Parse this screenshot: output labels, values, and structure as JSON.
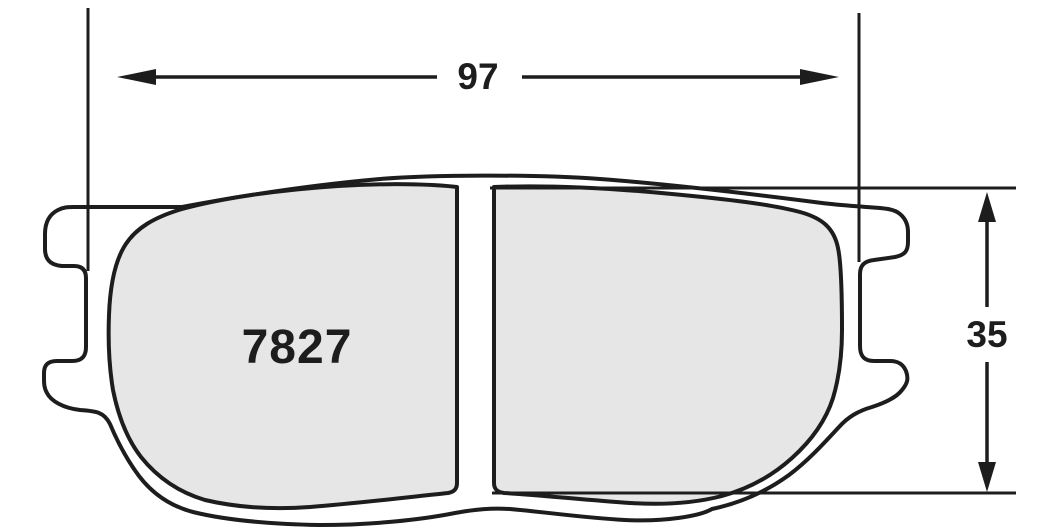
{
  "part": {
    "number_label": "7827"
  },
  "dimensions": {
    "width_label": "97",
    "height_label": "35"
  },
  "colors": {
    "line": "#1d1d1d",
    "pad_fill": "#e6e6e7",
    "plate_fill": "#ffffff",
    "background": "#ffffff"
  }
}
